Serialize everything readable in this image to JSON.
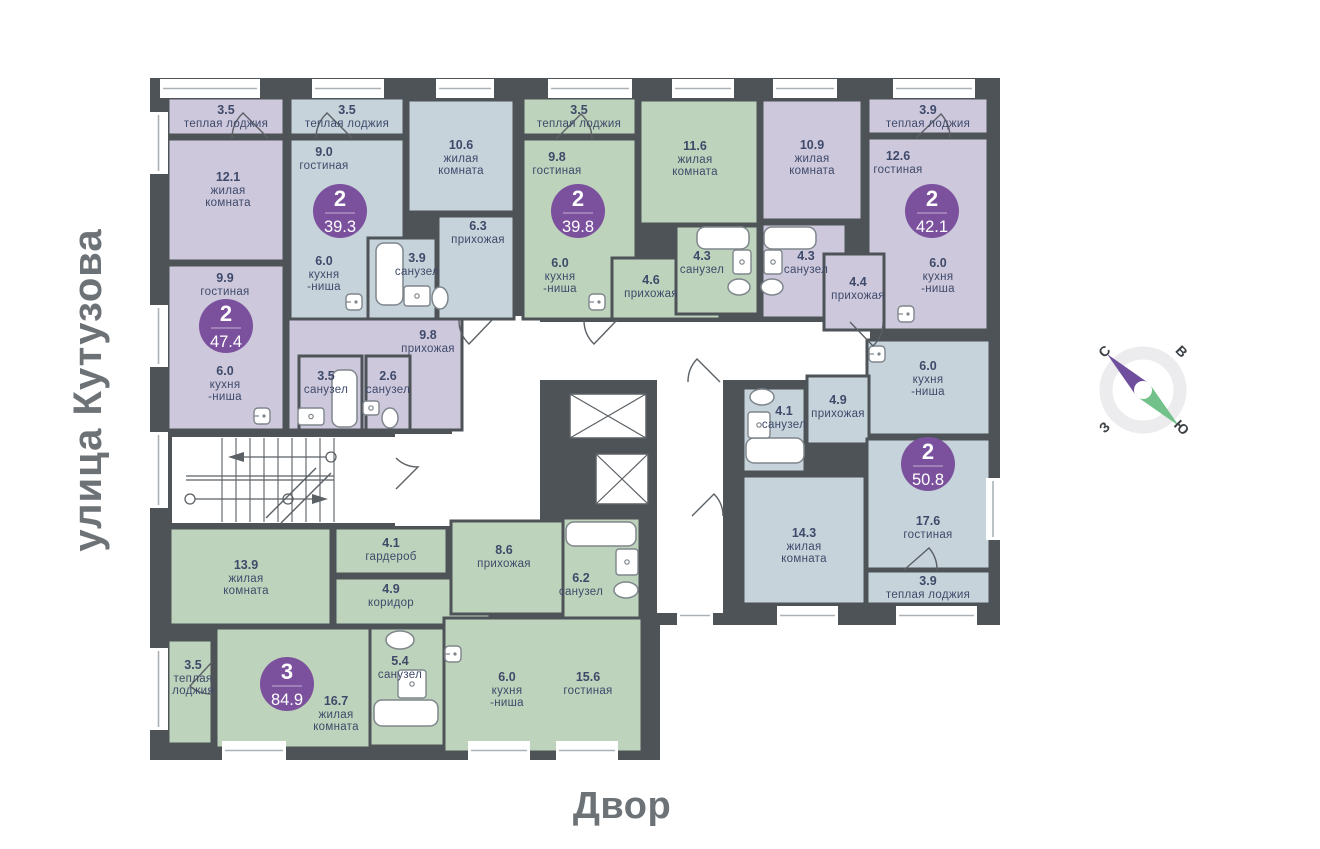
{
  "labels": {
    "street": "улица Кутузова",
    "courtyard": "Двор"
  },
  "compass": {
    "n": "С",
    "e": "В",
    "w": "З",
    "s": "Ю"
  },
  "colors": {
    "wall": "#4e5358",
    "purple": "#cdc8dc",
    "blue": "#c6d3da",
    "green": "#bed3bb",
    "badge": "#7b519e",
    "room_text": "#3f4a6a",
    "muted_text": "#6d7277",
    "fixture_stroke": "#7e868c",
    "door_stroke": "#5b6065",
    "window_line": "#aab2b7",
    "compass_north": "#6f4f9d",
    "compass_south": "#72c18a",
    "compass_ring": "#ececee"
  },
  "apartments": [
    {
      "id": "47-4",
      "color": "purple",
      "badge": {
        "rooms": "2",
        "area": "47.4",
        "x": 226,
        "y": 326
      },
      "rooms": [
        {
          "area": "3.5",
          "name": [
            "теплая лоджия"
          ],
          "rect": [
            168,
            98,
            116,
            37
          ],
          "label": [
            226,
            105
          ]
        },
        {
          "area": "12.1",
          "name": [
            "жилая",
            "комната"
          ],
          "rect": [
            168,
            139,
            116,
            122
          ],
          "label": [
            228,
            172
          ]
        },
        {
          "area": "9.9",
          "name": [
            "гостиная"
          ],
          "rect": [
            168,
            265,
            116,
            165
          ],
          "label": [
            225,
            273
          ]
        },
        {
          "area": "6.0",
          "name": [
            "кухня",
            "-ниша"
          ],
          "rect": null,
          "label": [
            225,
            366
          ]
        },
        {
          "area": "9.8",
          "name": [
            "прихожая"
          ],
          "rect": [
            288,
            318,
            174,
            112
          ],
          "label": [
            428,
            330
          ]
        },
        {
          "area": "3.5",
          "name": [
            "санузел"
          ],
          "rect": [
            299,
            356,
            63,
            74
          ],
          "label": [
            326,
            371
          ]
        },
        {
          "area": "2.6",
          "name": [
            "санузел"
          ],
          "rect": [
            366,
            356,
            44,
            74
          ],
          "label": [
            388,
            371
          ]
        }
      ]
    },
    {
      "id": "39-3",
      "color": "blue",
      "badge": {
        "rooms": "2",
        "area": "39.3",
        "x": 340,
        "y": 211
      },
      "rooms": [
        {
          "area": "3.5",
          "name": [
            "теплая лоджия"
          ],
          "rect": [
            290,
            98,
            114,
            37
          ],
          "label": [
            347,
            105
          ]
        },
        {
          "area": "9.0",
          "name": [
            "гостиная"
          ],
          "rect": [
            290,
            139,
            114,
            180
          ],
          "label": [
            324,
            147
          ]
        },
        {
          "area": "6.0",
          "name": [
            "кухня",
            "-ниша"
          ],
          "rect": null,
          "label": [
            324,
            256
          ]
        },
        {
          "area": "10.6",
          "name": [
            "жилая",
            "комната"
          ],
          "rect": [
            408,
            100,
            106,
            112
          ],
          "label": [
            461,
            140
          ]
        },
        {
          "area": "6.3",
          "name": [
            "прихожая"
          ],
          "rect": [
            438,
            216,
            76,
            103
          ],
          "label": [
            478,
            221
          ]
        },
        {
          "area": "3.9",
          "name": [
            "санузел"
          ],
          "rect": [
            368,
            238,
            68,
            81
          ],
          "label": [
            417,
            253
          ]
        }
      ]
    },
    {
      "id": "39-8",
      "color": "green",
      "badge": {
        "rooms": "2",
        "area": "39.8",
        "x": 578,
        "y": 211
      },
      "rooms": [
        {
          "area": "3.5",
          "name": [
            "теплая лоджия"
          ],
          "rect": [
            523,
            98,
            113,
            37
          ],
          "label": [
            579,
            105
          ]
        },
        {
          "area": "9.8",
          "name": [
            "гостиная"
          ],
          "rect": [
            523,
            139,
            113,
            180
          ],
          "label": [
            557,
            152
          ]
        },
        {
          "area": "6.0",
          "name": [
            "кухня",
            "-ниша"
          ],
          "rect": null,
          "label": [
            560,
            258
          ]
        },
        {
          "area": "11.6",
          "name": [
            "жилая",
            "комната"
          ],
          "rect": [
            640,
            100,
            118,
            124
          ],
          "label": [
            695,
            141
          ]
        },
        {
          "area": "4.6",
          "name": [
            "прихожая"
          ],
          "rect": [
            612,
            258,
            108,
            61
          ],
          "label": [
            651,
            275
          ]
        },
        {
          "area": "4.3",
          "name": [
            "санузел"
          ],
          "rect": [
            676,
            226,
            82,
            88
          ],
          "label": [
            702,
            251
          ]
        }
      ]
    },
    {
      "id": "42-1",
      "color": "purple",
      "badge": {
        "rooms": "2",
        "area": "42.1",
        "x": 932,
        "y": 211
      },
      "rooms": [
        {
          "area": "3.9",
          "name": [
            "теплая лоджия"
          ],
          "rect": [
            868,
            98,
            120,
            36
          ],
          "label": [
            928,
            105
          ]
        },
        {
          "area": "10.9",
          "name": [
            "жилая",
            "комната"
          ],
          "rect": [
            762,
            100,
            100,
            120
          ],
          "label": [
            812,
            140
          ]
        },
        {
          "area": "12.6",
          "name": [
            "гостиная"
          ],
          "rect": [
            868,
            138,
            120,
            192
          ],
          "label": [
            898,
            151
          ]
        },
        {
          "area": "6.0",
          "name": [
            "кухня",
            "-ниша"
          ],
          "rect": null,
          "label": [
            938,
            258
          ]
        },
        {
          "area": "4.3",
          "name": [
            "санузел"
          ],
          "rect": [
            762,
            224,
            84,
            94
          ],
          "label": [
            806,
            251
          ]
        },
        {
          "area": "4.4",
          "name": [
            "прихожая"
          ],
          "rect": [
            824,
            254,
            60,
            76
          ],
          "label": [
            858,
            277
          ]
        }
      ]
    },
    {
      "id": "50-8",
      "color": "blue",
      "badge": {
        "rooms": "2",
        "area": "50.8",
        "x": 928,
        "y": 464
      },
      "rooms": [
        {
          "area": "6.0",
          "name": [
            "кухня",
            "-ниша"
          ],
          "rect": [
            867,
            340,
            123,
            95
          ],
          "label": [
            928,
            361
          ]
        },
        {
          "area": "4.1",
          "name": [
            "санузел"
          ],
          "rect": [
            743,
            388,
            62,
            84
          ],
          "label": [
            784,
            406
          ]
        },
        {
          "area": "4.9",
          "name": [
            "прихожая"
          ],
          "rect": [
            807,
            376,
            62,
            68
          ],
          "label": [
            838,
            395
          ]
        },
        {
          "area": "17.6",
          "name": [
            "гостиная"
          ],
          "rect": [
            867,
            439,
            123,
            130
          ],
          "label": [
            928,
            516
          ]
        },
        {
          "area": "14.3",
          "name": [
            "жилая",
            "комната"
          ],
          "rect": [
            743,
            476,
            122,
            128
          ],
          "label": [
            804,
            528
          ]
        },
        {
          "area": "3.9",
          "name": [
            "теплая лоджия"
          ],
          "rect": [
            867,
            571,
            123,
            33
          ],
          "label": [
            928,
            576
          ]
        }
      ]
    },
    {
      "id": "84-9",
      "color": "green",
      "badge": {
        "rooms": "3",
        "area": "84.9",
        "x": 287,
        "y": 684
      },
      "rooms": [
        {
          "area": "13.9",
          "name": [
            "жилая",
            "комната"
          ],
          "rect": [
            170,
            528,
            161,
            97
          ],
          "label": [
            246,
            560
          ]
        },
        {
          "area": "4.1",
          "name": [
            "гардероб"
          ],
          "rect": [
            335,
            528,
            112,
            46
          ],
          "label": [
            391,
            538
          ]
        },
        {
          "area": "4.9",
          "name": [
            "коридор"
          ],
          "rect": [
            335,
            578,
            155,
            47
          ],
          "label": [
            391,
            584
          ]
        },
        {
          "area": "8.6",
          "name": [
            "прихожая"
          ],
          "rect": [
            451,
            521,
            112,
            93
          ],
          "label": [
            504,
            545
          ]
        },
        {
          "area": "6.2",
          "name": [
            "санузел"
          ],
          "rect": [
            563,
            518,
            77,
            100
          ],
          "label": [
            581,
            573
          ]
        },
        {
          "area": "3.5",
          "name": [
            "теплая",
            "лоджия"
          ],
          "rect": [
            168,
            640,
            44,
            104
          ],
          "label": [
            193,
            660
          ]
        },
        {
          "area": "16.7",
          "name": [
            "жилая",
            "комната"
          ],
          "rect": [
            216,
            628,
            224,
            120
          ],
          "label": [
            336,
            696
          ]
        },
        {
          "area": "5.4",
          "name": [
            "санузел"
          ],
          "rect": [
            370,
            628,
            74,
            118
          ],
          "label": [
            400,
            656
          ]
        },
        {
          "area": "15.6",
          "name": [
            "гостиная"
          ],
          "rect": [
            444,
            618,
            198,
            134
          ],
          "label": [
            588,
            672
          ]
        },
        {
          "area": "6.0",
          "name": [
            "кухня",
            "-ниша"
          ],
          "rect": null,
          "label": [
            507,
            672
          ]
        }
      ]
    }
  ]
}
